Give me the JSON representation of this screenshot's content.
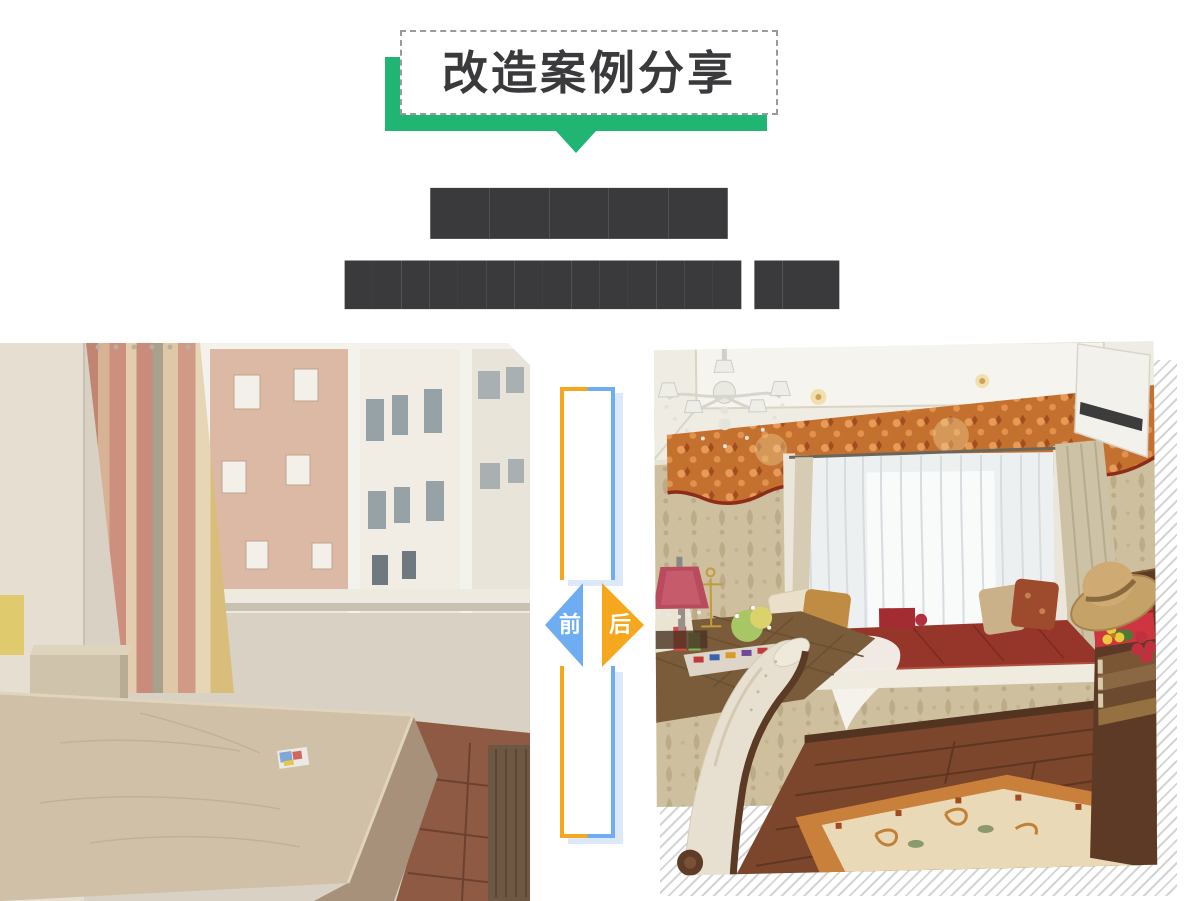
{
  "badge": {
    "title": "改造案例分享"
  },
  "headline": {
    "title_redacted": "██████████",
    "subtitle_redacted_a": "██████████████",
    "subtitle_redacted_b": "███"
  },
  "comparison": {
    "before_label": "前",
    "after_label": "后"
  },
  "colors": {
    "accent_green": "#20b573",
    "before_blue": "#6fadf2",
    "after_orange": "#f5a81e",
    "dashed_border_gray": "#9a9a9a",
    "title_text": "#3a3a3c",
    "frame_shadow_blue": "#dbe9fb",
    "hatch_gray": "#d4d4d4"
  }
}
